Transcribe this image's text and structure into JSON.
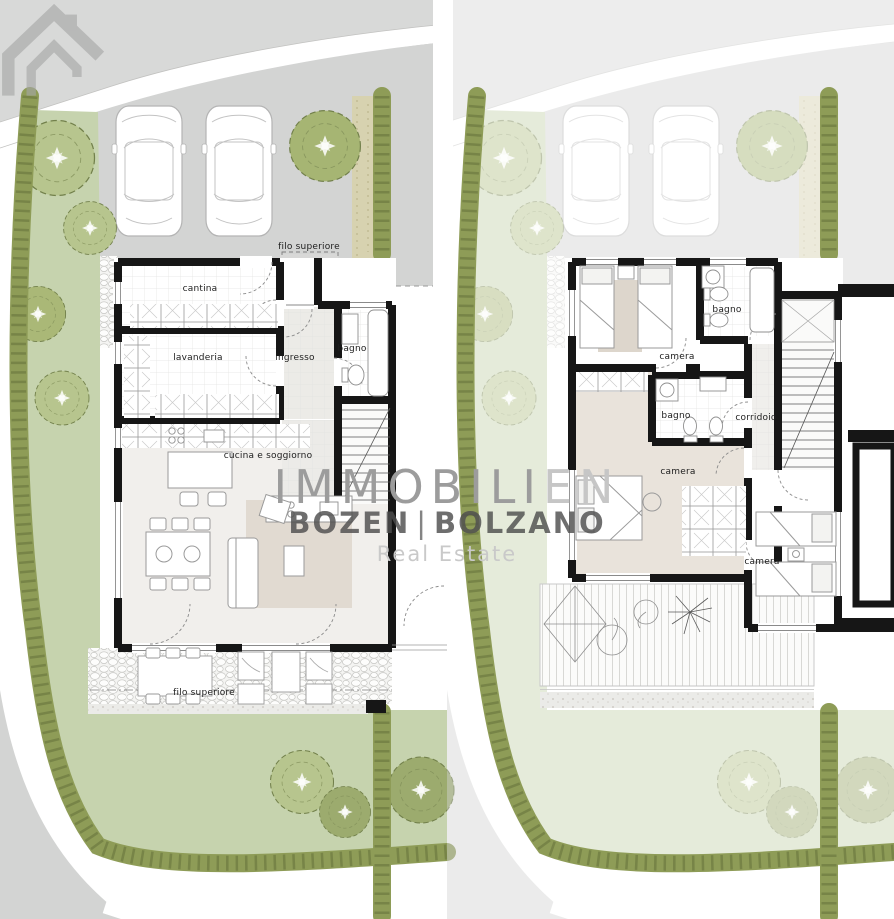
{
  "watermark": {
    "brand": "IMMOBILI",
    "brand_suffix": "EN",
    "city_primary": "BOZEN",
    "city_separator": "|",
    "city_secondary": "BOLZANO",
    "tagline": "Real Estate",
    "logo": "house-roof-logo"
  },
  "ground": {
    "labels": {
      "filo_top": "filo superiore",
      "cantina": "cantina",
      "lavanderia": "lavanderia",
      "ingresso": "ingresso",
      "bagno": "bagno",
      "cucina": "cucina e soggiorno",
      "filo_bottom": "filo superiore"
    }
  },
  "upper": {
    "labels": {
      "camera_1": "camera",
      "bagno_1": "bagno",
      "bagno_2": "bagno",
      "corridoio": "corridoio",
      "camera_2": "camera",
      "camera_3": "camera"
    }
  },
  "colors": {
    "wall": "#161616",
    "hedge": "#8e9c57",
    "hedge_texture": "#5f6c38",
    "tree": "#b7c58e",
    "lawn": "#c6d3ae",
    "road": "#d3d4d3",
    "path": "#d7d2b0",
    "entrance_arrow": "#e02318",
    "rug": "#e1dad1",
    "watermark_text": "#9c9c9c",
    "watermark_dark": "#4f4f4f"
  }
}
